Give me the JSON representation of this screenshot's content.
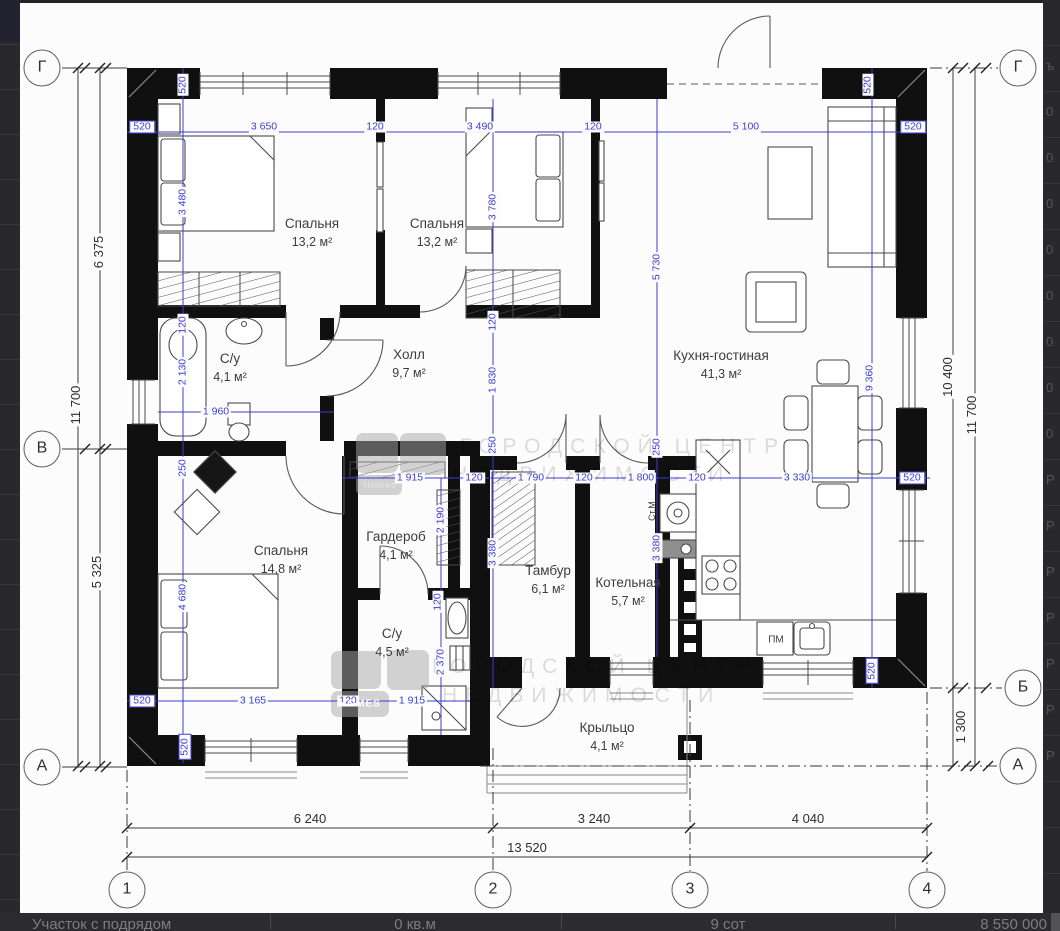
{
  "plan": {
    "rooms": [
      {
        "name": "Спальня",
        "area": "13,2 м²",
        "x": 312,
        "y": 233
      },
      {
        "name": "Спальня",
        "area": "13,2 м²",
        "x": 437,
        "y": 233
      },
      {
        "name": "С/у",
        "area": "4,1 м²",
        "x": 230,
        "y": 368
      },
      {
        "name": "Холл",
        "area": "9,7 м²",
        "x": 409,
        "y": 364
      },
      {
        "name": "Кухня-гостиная",
        "area": "41,3 м²",
        "x": 721,
        "y": 365
      },
      {
        "name": "Спальня",
        "area": "14,8 м²",
        "x": 281,
        "y": 560
      },
      {
        "name": "Гардероб",
        "area": "4,1 м²",
        "x": 396,
        "y": 546
      },
      {
        "name": "С/у",
        "area": "4,5 м²",
        "x": 392,
        "y": 643
      },
      {
        "name": "Тамбур",
        "area": "6,1 м²",
        "x": 548,
        "y": 580
      },
      {
        "name": "Котельная",
        "area": "5,7 м²",
        "x": 628,
        "y": 592
      },
      {
        "name": "Крыльцо",
        "area": "4,1 м²",
        "x": 607,
        "y": 737
      }
    ],
    "dims_blue": [
      {
        "t": "520",
        "x": 142,
        "y": 127,
        "boxed": 1
      },
      {
        "t": "3 650",
        "x": 264,
        "y": 127
      },
      {
        "t": "120",
        "x": 375,
        "y": 127
      },
      {
        "t": "3 490",
        "x": 480,
        "y": 127
      },
      {
        "t": "120",
        "x": 593,
        "y": 127
      },
      {
        "t": "5 100",
        "x": 746,
        "y": 127
      },
      {
        "t": "520",
        "x": 913,
        "y": 127,
        "boxed": 1
      },
      {
        "t": "520",
        "x": 183,
        "y": 85,
        "rot": 1
      },
      {
        "t": "520",
        "x": 868,
        "y": 85,
        "rot": 1
      },
      {
        "t": "3 480",
        "x": 183,
        "y": 202,
        "rot": 1
      },
      {
        "t": "120",
        "x": 183,
        "y": 325,
        "rot": 1
      },
      {
        "t": "2 130",
        "x": 183,
        "y": 372,
        "rot": 1
      },
      {
        "t": "250",
        "x": 183,
        "y": 468,
        "rot": 1
      },
      {
        "t": "4 680",
        "x": 183,
        "y": 597,
        "rot": 1
      },
      {
        "t": "520",
        "x": 185,
        "y": 747,
        "rot": 1,
        "boxed": 1
      },
      {
        "t": "1 960",
        "x": 216,
        "y": 412
      },
      {
        "t": "3 780",
        "x": 493,
        "y": 207,
        "rot": 1
      },
      {
        "t": "120",
        "x": 493,
        "y": 322,
        "rot": 1
      },
      {
        "t": "1 830",
        "x": 493,
        "y": 380,
        "rot": 1
      },
      {
        "t": "250",
        "x": 493,
        "y": 445,
        "rot": 1
      },
      {
        "t": "3 380",
        "x": 493,
        "y": 553,
        "rot": 1
      },
      {
        "t": "5 730",
        "x": 657,
        "y": 267,
        "rot": 1
      },
      {
        "t": "250",
        "x": 657,
        "y": 447,
        "rot": 1
      },
      {
        "t": "3 380",
        "x": 657,
        "y": 548,
        "rot": 1
      },
      {
        "t": "9 360",
        "x": 870,
        "y": 378,
        "rot": 1
      },
      {
        "t": "520",
        "x": 872,
        "y": 671,
        "rot": 1,
        "boxed": 1
      },
      {
        "t": "1 915",
        "x": 410,
        "y": 478
      },
      {
        "t": "120",
        "x": 474,
        "y": 478
      },
      {
        "t": "1 790",
        "x": 531,
        "y": 478
      },
      {
        "t": "120",
        "x": 584,
        "y": 478
      },
      {
        "t": "1 800",
        "x": 641,
        "y": 478
      },
      {
        "t": "120",
        "x": 697,
        "y": 478
      },
      {
        "t": "3 330",
        "x": 797,
        "y": 478
      },
      {
        "t": "520",
        "x": 912,
        "y": 478,
        "boxed": 1
      },
      {
        "t": "2 190",
        "x": 441,
        "y": 520,
        "rot": 1
      },
      {
        "t": "120",
        "x": 438,
        "y": 602,
        "rot": 1
      },
      {
        "t": "2 370",
        "x": 441,
        "y": 662,
        "rot": 1
      },
      {
        "t": "520",
        "x": 142,
        "y": 701,
        "boxed": 1
      },
      {
        "t": "3 165",
        "x": 253,
        "y": 701
      },
      {
        "t": "120",
        "x": 348,
        "y": 701
      },
      {
        "t": "1 915",
        "x": 412,
        "y": 701
      }
    ],
    "dims_black": [
      {
        "t": "6 375",
        "x": 99,
        "y": 252,
        "rot": 1
      },
      {
        "t": "11 700",
        "x": 76,
        "y": 405,
        "rot": 1
      },
      {
        "t": "5 325",
        "x": 97,
        "y": 572,
        "rot": 1
      },
      {
        "t": "10 400",
        "x": 948,
        "y": 377,
        "rot": 1
      },
      {
        "t": "11 700",
        "x": 972,
        "y": 415,
        "rot": 1
      },
      {
        "t": "1 300",
        "x": 961,
        "y": 727,
        "rot": 1
      },
      {
        "t": "6 240",
        "x": 310,
        "y": 819
      },
      {
        "t": "3 240",
        "x": 594,
        "y": 819
      },
      {
        "t": "4 040",
        "x": 808,
        "y": 819
      },
      {
        "t": "13 520",
        "x": 527,
        "y": 848
      }
    ],
    "axes": [
      {
        "label": "Г",
        "x": 42,
        "y": 68
      },
      {
        "label": "Г",
        "x": 1018,
        "y": 68
      },
      {
        "label": "В",
        "x": 42,
        "y": 449
      },
      {
        "label": "Б",
        "x": 1023,
        "y": 688
      },
      {
        "label": "А",
        "x": 42,
        "y": 767
      },
      {
        "label": "А",
        "x": 1018,
        "y": 766
      },
      {
        "label": "1",
        "x": 127,
        "y": 890
      },
      {
        "label": "2",
        "x": 493,
        "y": 890
      },
      {
        "label": "3",
        "x": 690,
        "y": 890
      },
      {
        "label": "4",
        "x": 927,
        "y": 890
      }
    ],
    "appliances": [
      {
        "t": "Ст.М",
        "x": 652,
        "y": 511,
        "rot": 1
      },
      {
        "t": "ПМ",
        "x": 776,
        "y": 640
      }
    ],
    "watermarks": [
      {
        "t": "ГОРОДСКОЙ ЦЕНТР",
        "x": 460,
        "y": 435
      },
      {
        "t": "НЕДВИЖИМОСТИ",
        "x": 452,
        "y": 463
      },
      {
        "t": "ГОРОДСКОЙ ЦЕНТР",
        "x": 432,
        "y": 655
      },
      {
        "t": "НЕДВИЖИМОСТИ",
        "x": 442,
        "y": 684
      }
    ],
    "logo_texts": [
      {
        "t": "Homes",
        "x": 380,
        "y": 485,
        "cls": "logo-faint"
      },
      {
        "t": "HOMES",
        "x": 360,
        "y": 704,
        "cls": "logo-strong"
      }
    ]
  },
  "right_strip_glyphs": [
    {
      "t": "ъ",
      "y": 58
    },
    {
      "t": "0",
      "y": 104
    },
    {
      "t": "0",
      "y": 150
    },
    {
      "t": "0",
      "y": 196
    },
    {
      "t": "0",
      "y": 242
    },
    {
      "t": "0",
      "y": 288
    },
    {
      "t": "0",
      "y": 334
    },
    {
      "t": "0",
      "y": 380
    },
    {
      "t": "0",
      "y": 426
    },
    {
      "t": "Р",
      "y": 472
    },
    {
      "t": "Р",
      "y": 518
    },
    {
      "t": "Р",
      "y": 564
    },
    {
      "t": "Р",
      "y": 610
    },
    {
      "t": "Р",
      "y": 656
    },
    {
      "t": "Р",
      "y": 702
    },
    {
      "t": "Р",
      "y": 748
    }
  ],
  "footer": {
    "cells": [
      "Участок с подрядом",
      "0 кв.м",
      "9 сот",
      "8 550 000"
    ]
  }
}
